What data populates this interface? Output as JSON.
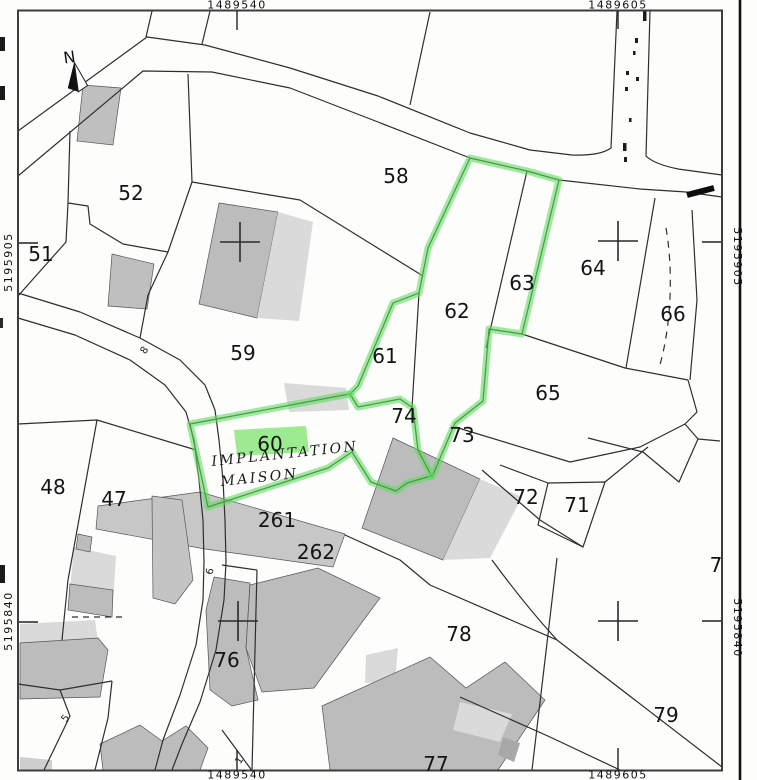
{
  "map_coordinates": {
    "top": [
      "1489540",
      "1489605"
    ],
    "bottom": [
      "1489540",
      "1489605"
    ],
    "left": [
      "5195905",
      "5195840"
    ],
    "right": [
      "5195905",
      "5195840"
    ]
  },
  "north_indicator": {
    "label": "N"
  },
  "parcels": [
    {
      "label": "51",
      "highlighted": false
    },
    {
      "label": "52",
      "highlighted": false
    },
    {
      "label": "58",
      "highlighted": false
    },
    {
      "label": "59",
      "highlighted": false
    },
    {
      "label": "60",
      "highlighted": true
    },
    {
      "label": "61",
      "highlighted": true
    },
    {
      "label": "62",
      "highlighted": true
    },
    {
      "label": "63",
      "highlighted": true
    },
    {
      "label": "64",
      "highlighted": false
    },
    {
      "label": "65",
      "highlighted": false
    },
    {
      "label": "66",
      "highlighted": false
    },
    {
      "label": "71",
      "highlighted": false
    },
    {
      "label": "72",
      "highlighted": false
    },
    {
      "label": "73",
      "highlighted": false
    },
    {
      "label": "74",
      "highlighted": false
    },
    {
      "label": "76",
      "highlighted": false
    },
    {
      "label": "77",
      "highlighted": false
    },
    {
      "label": "78",
      "highlighted": false
    },
    {
      "label": "79",
      "highlighted": false
    },
    {
      "label": "7",
      "highlighted": false
    },
    {
      "label": "261",
      "highlighted": false
    },
    {
      "label": "262",
      "highlighted": false
    },
    {
      "label": "47",
      "highlighted": false
    },
    {
      "label": "48",
      "highlighted": false
    }
  ],
  "road_labels": [
    {
      "label": "8"
    },
    {
      "label": "6"
    },
    {
      "label": "5"
    },
    {
      "label": "1"
    }
  ],
  "annotation": {
    "line1": "IMPLANTATION",
    "line2": "MAISON"
  },
  "highlight": {
    "stroke": "#5fdc5f",
    "label_swipe": "#8ce87c"
  }
}
